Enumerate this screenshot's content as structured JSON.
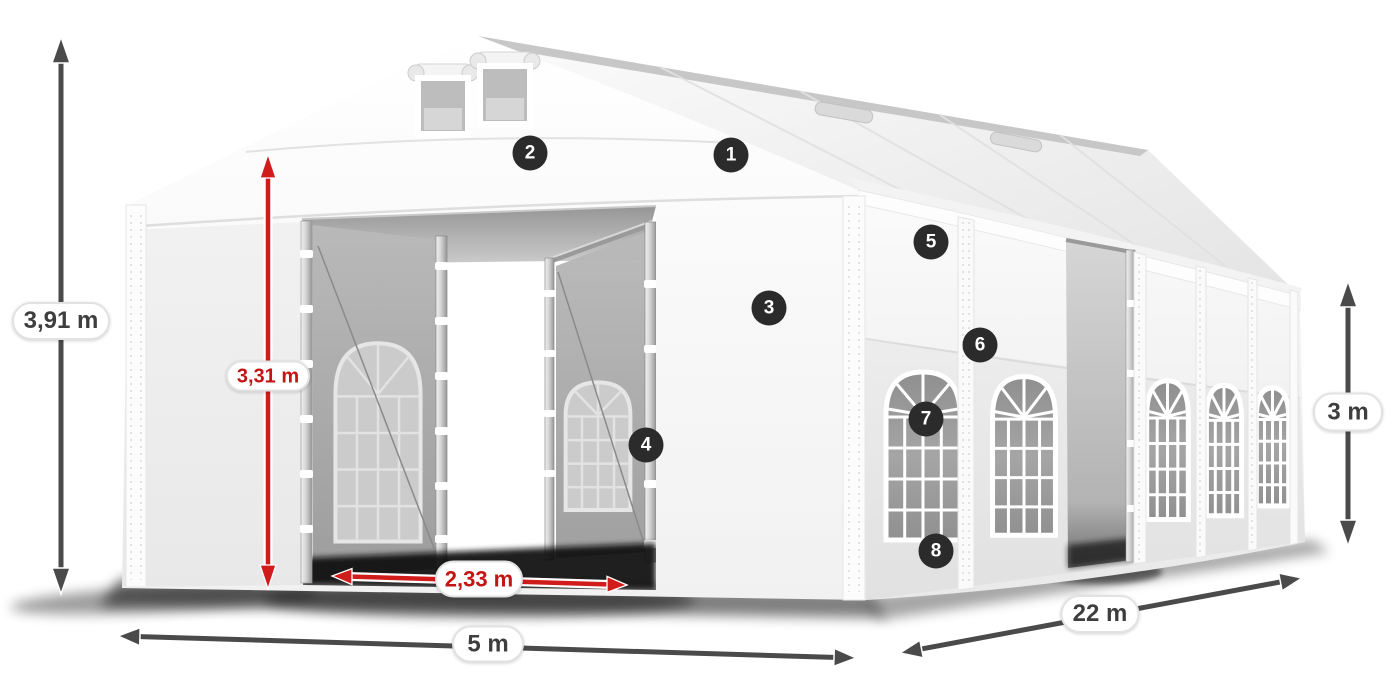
{
  "dimensions": {
    "total_height": "3,91 m",
    "clearance_height": "3,31 m",
    "entrance_width": "2,33 m",
    "front_width": "5 m",
    "side_length": "22 m",
    "wall_height": "3 m"
  },
  "markers": [
    "1",
    "2",
    "3",
    "4",
    "5",
    "6",
    "7",
    "8"
  ],
  "colors": {
    "dimension_red": "#c51414",
    "dimension_dark": "#4a4a4a",
    "badge_background": "#2b2b2b",
    "label_text": "#3e3e3e",
    "tent_white": "#ffffff"
  }
}
